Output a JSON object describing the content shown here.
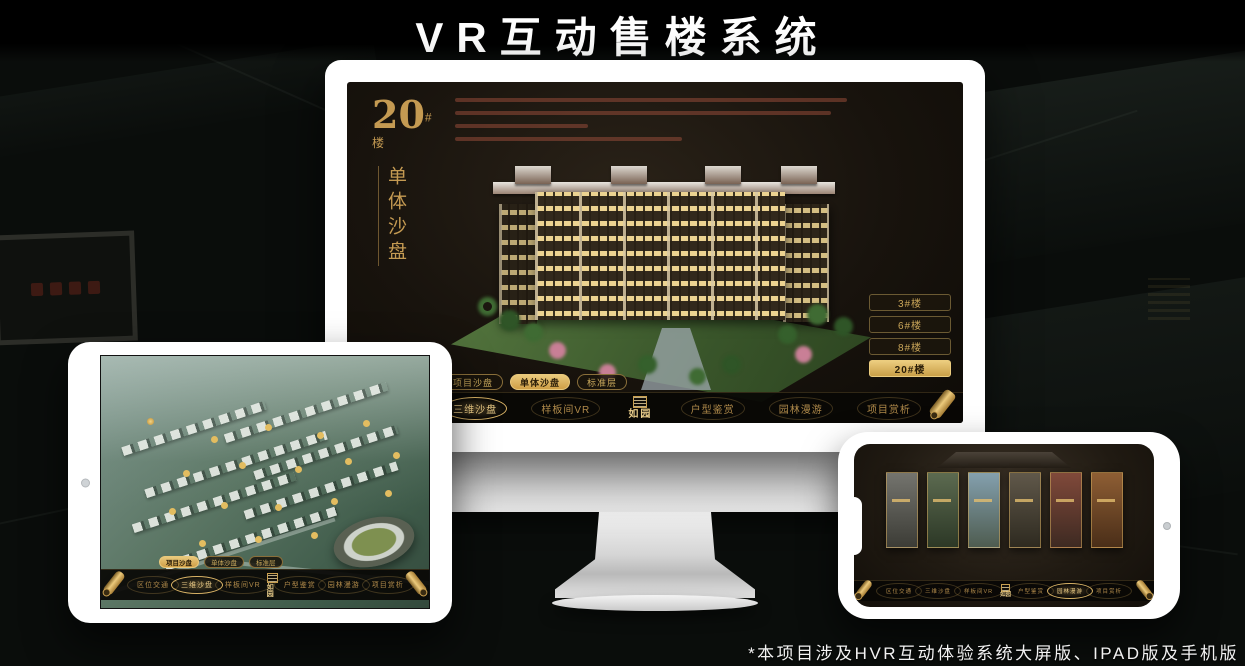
{
  "page": {
    "title": "VR互动售楼系统",
    "footnote": "*本项目涉及HVR互动体验系统大屏版、IPAD版及手机版"
  },
  "brand": {
    "logo_name": "如园"
  },
  "colors": {
    "gold": "#d2a75c",
    "gold_active": "#e9c97c",
    "screen_bg": "#18130d",
    "nav_bg": "#090705",
    "paragraph_text": "#944a38"
  },
  "monitor": {
    "headline": {
      "number": "20",
      "unit": "#楼",
      "subtitle": "单体沙盘"
    },
    "floor_buttons": [
      {
        "label": "3#楼",
        "active": false
      },
      {
        "label": "6#楼",
        "active": false
      },
      {
        "label": "8#楼",
        "active": false
      },
      {
        "label": "20#楼",
        "active": true
      }
    ],
    "view_tabs": [
      {
        "label": "项目沙盘",
        "active": false
      },
      {
        "label": "单体沙盘",
        "active": true
      },
      {
        "label": "标准层",
        "active": false
      }
    ],
    "nav_items": [
      {
        "label": "区位交通",
        "active": false
      },
      {
        "label": "三维沙盘",
        "active": true
      },
      {
        "label": "样板间VR",
        "active": false
      },
      {
        "label": "户型鉴赏",
        "active": false
      },
      {
        "label": "园林漫游",
        "active": false
      },
      {
        "label": "项目赏析",
        "active": false
      }
    ]
  },
  "tablet": {
    "view_tabs": [
      {
        "label": "项目沙盘",
        "active": true
      },
      {
        "label": "单体沙盘",
        "active": false
      },
      {
        "label": "标准层",
        "active": false
      }
    ],
    "nav_items": [
      {
        "label": "区位交通",
        "active": false
      },
      {
        "label": "三维沙盘",
        "active": true
      },
      {
        "label": "样板间VR",
        "active": false
      },
      {
        "label": "户型鉴赏",
        "active": false
      },
      {
        "label": "园林漫游",
        "active": false
      },
      {
        "label": "项目赏析",
        "active": false
      }
    ]
  },
  "phone": {
    "nav_items": [
      {
        "label": "区位交通",
        "active": false
      },
      {
        "label": "三维沙盘",
        "active": false
      },
      {
        "label": "样板间VR",
        "active": false
      },
      {
        "label": "户型鉴赏",
        "active": false
      },
      {
        "label": "园林漫游",
        "active": true
      },
      {
        "label": "项目赏析",
        "active": false
      }
    ]
  }
}
